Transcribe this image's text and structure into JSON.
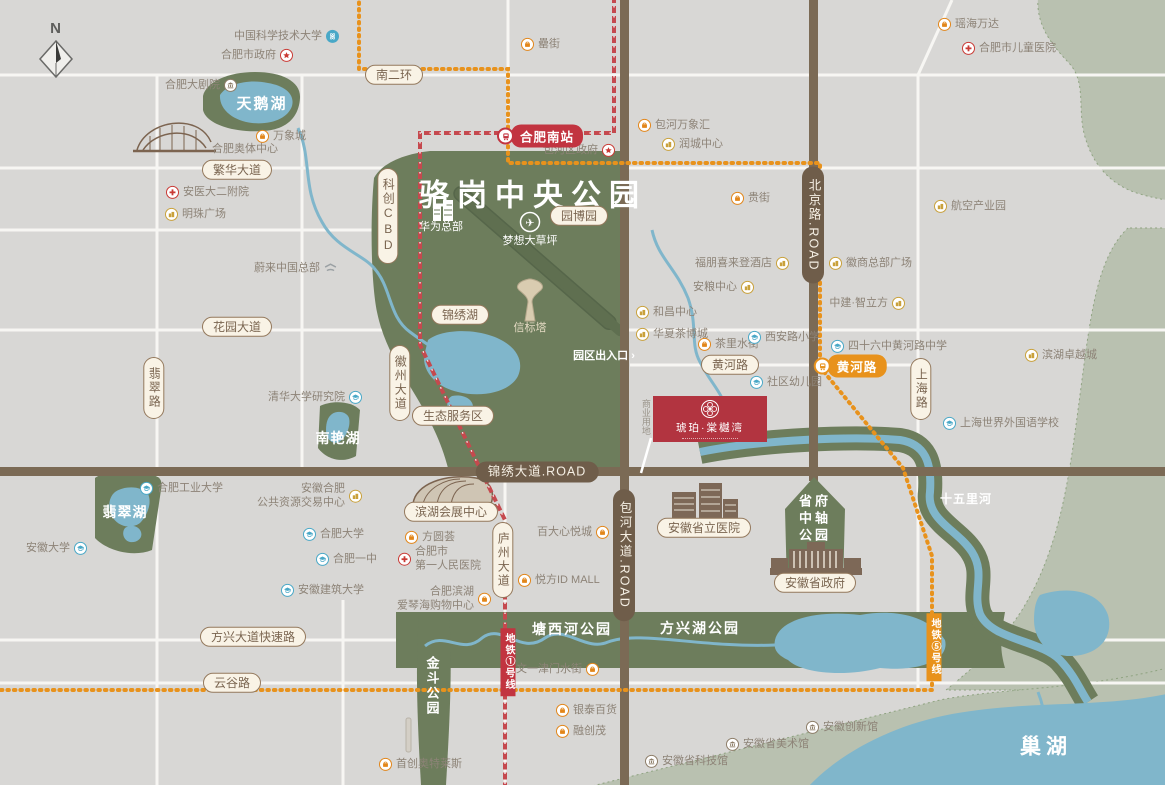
{
  "compass": {
    "label": "N"
  },
  "property": {
    "name": "琥珀·棠樾湾"
  },
  "park": {
    "title": "骆岗中央公园"
  },
  "colors": {
    "background": "#d8d7d5",
    "park_green": "#6d7d5c",
    "sage_green": "#b9c1b0",
    "water_blue": "#80b6cb",
    "road_brown": "#7b6a55",
    "metro_line1_red": "#c5494e",
    "metro_line5_orange": "#e8921c",
    "property_red": "#b23440",
    "poi_mall_orange": "#e2861a",
    "poi_biz_yellow": "#c9a13b",
    "poi_school_blue": "#49a8c7",
    "poi_gov_red": "#c93a35",
    "poi_museum_brown": "#8d7d68"
  },
  "metro": {
    "stations": [
      {
        "id": "hefei-south",
        "label": "合肥南站",
        "x": 540,
        "y": 136,
        "line": "red"
      },
      {
        "id": "huanghe-road",
        "label": "黄河路",
        "x": 850,
        "y": 366,
        "line": "orange"
      }
    ],
    "line_badges": [
      {
        "id": "line1",
        "label": "地铁①号线",
        "x": 508,
        "y": 662,
        "line": "red"
      },
      {
        "id": "line5",
        "label": "地铁⑤号线",
        "x": 934,
        "y": 647,
        "line": "orange"
      }
    ]
  },
  "road_labels": [
    {
      "id": "south-2nd-ring",
      "text": "南二环",
      "x": 394,
      "y": 75,
      "dir": "h",
      "style": "light"
    },
    {
      "id": "fanhua-ave",
      "text": "繁华大道",
      "x": 237,
      "y": 170,
      "dir": "h",
      "style": "light"
    },
    {
      "id": "huayuan-ave",
      "text": "花园大道",
      "x": 237,
      "y": 327,
      "dir": "h",
      "style": "light"
    },
    {
      "id": "feicui-road",
      "text": "翡翠路",
      "x": 154,
      "y": 388,
      "dir": "v",
      "style": "light"
    },
    {
      "id": "kechuang-cbd",
      "text": "科创CBD",
      "x": 388,
      "y": 216,
      "dir": "v",
      "style": "light"
    },
    {
      "id": "huizhou-ave",
      "text": "徽州大道",
      "x": 400,
      "y": 383,
      "dir": "v",
      "style": "light"
    },
    {
      "id": "jinxiu-lake",
      "text": "锦绣湖",
      "x": 460,
      "y": 315,
      "dir": "h",
      "style": "light"
    },
    {
      "id": "eco-service-area",
      "text": "生态服务区",
      "x": 453,
      "y": 416,
      "dir": "h",
      "style": "light"
    },
    {
      "id": "yuanboyuan",
      "text": "园博园",
      "x": 579,
      "y": 216,
      "dir": "h",
      "style": "light"
    },
    {
      "id": "huanghe-road-pill",
      "text": "黄河路",
      "x": 730,
      "y": 365,
      "dir": "h",
      "style": "light"
    },
    {
      "id": "shanghai-road",
      "text": "上海路",
      "x": 921,
      "y": 389,
      "dir": "v",
      "style": "light"
    },
    {
      "id": "luzhou-ave",
      "text": "庐州大道",
      "x": 503,
      "y": 560,
      "dir": "v",
      "style": "light"
    },
    {
      "id": "fangxing-expressway",
      "text": "方兴大道快速路",
      "x": 253,
      "y": 637,
      "dir": "h",
      "style": "light"
    },
    {
      "id": "yungu-road",
      "text": "云谷路",
      "x": 232,
      "y": 683,
      "dir": "h",
      "style": "light"
    },
    {
      "id": "binhu-expo-center",
      "text": "滨湖会展中心",
      "x": 451,
      "y": 512,
      "dir": "h",
      "style": "light"
    },
    {
      "id": "anhui-provincial-hospital",
      "text": "安徽省立医院",
      "x": 704,
      "y": 528,
      "dir": "h",
      "style": "light"
    },
    {
      "id": "anhui-provincial-gov",
      "text": "安徽省政府",
      "x": 815,
      "y": 583,
      "dir": "h",
      "style": "light"
    },
    {
      "id": "jinxiu-ave",
      "text": "锦绣大道.ROAD",
      "x": 537,
      "y": 472,
      "dir": "h",
      "style": "dark"
    },
    {
      "id": "baohe-ave",
      "text": "包河大道.ROAD",
      "x": 624,
      "y": 555,
      "dir": "v",
      "style": "dark"
    },
    {
      "id": "beijing-road",
      "text": "北京路.ROAD",
      "x": 813,
      "y": 225,
      "dir": "v",
      "style": "dark"
    }
  ],
  "area_labels": [
    {
      "id": "luogang-park-title",
      "text": "骆岗中央公园",
      "x": 533,
      "y": 196,
      "size": 30,
      "color": "#ffffff",
      "bold": true,
      "spacing": 8
    },
    {
      "id": "swan-lake",
      "text": "天鹅湖",
      "x": 262,
      "y": 104,
      "size": 15,
      "color": "#ffffff",
      "bold": true,
      "spacing": 2
    },
    {
      "id": "nanyan-lake",
      "text": "南艳湖",
      "x": 338,
      "y": 438,
      "size": 14,
      "color": "#ffffff",
      "bold": true,
      "spacing": 1
    },
    {
      "id": "feicui-lake",
      "text": "翡翠湖",
      "x": 125,
      "y": 512,
      "size": 14,
      "color": "#ffffff",
      "bold": true,
      "spacing": 1
    },
    {
      "id": "tangxihe-park",
      "text": "塘西河公园",
      "x": 572,
      "y": 629,
      "size": 14,
      "color": "#ffffff",
      "bold": true,
      "spacing": 2
    },
    {
      "id": "fangxinghu-park",
      "text": "方兴湖公园",
      "x": 700,
      "y": 628,
      "size": 14,
      "color": "#ffffff",
      "bold": true,
      "spacing": 2
    },
    {
      "id": "jindou-park",
      "text": "金斗公园",
      "x": 431,
      "y": 686,
      "size": 13,
      "color": "#ffffff",
      "bold": true,
      "vertical": true,
      "spacing": 2
    },
    {
      "id": "shiwuli-river",
      "text": "十五里河",
      "x": 966,
      "y": 500,
      "size": 12,
      "color": "#ffffff",
      "bold": true,
      "spacing": 1
    },
    {
      "id": "chao-lake",
      "text": "巢湖",
      "x": 1046,
      "y": 747,
      "size": 21,
      "color": "#ffffff",
      "bold": true,
      "spacing": 5
    },
    {
      "id": "park-entrance",
      "text": "园区出入口 ›",
      "x": 604,
      "y": 356,
      "size": 11,
      "color": "#ffffff",
      "bold": true
    },
    {
      "id": "dream-lawn",
      "text": "梦想大草坪",
      "x": 530,
      "y": 241,
      "size": 11,
      "color": "#ffffff"
    },
    {
      "id": "huawei-hq",
      "text": "华为总部",
      "x": 441,
      "y": 227,
      "size": 11,
      "color": "#ffffff"
    },
    {
      "id": "beacon-tower",
      "text": "信标塔",
      "x": 530,
      "y": 328,
      "size": 11,
      "color": "#e3d9c2"
    },
    {
      "id": "olympic-center",
      "text": "合肥奥体中心",
      "x": 245,
      "y": 149,
      "size": 11,
      "color": "#8d8377"
    },
    {
      "id": "commercial-plot",
      "text": "商业用地",
      "x": 645,
      "y": 417,
      "size": 9,
      "color": "#9a948a",
      "vertical": true
    },
    {
      "id": "shengfu-axis-park",
      "text": "省府\n中轴\n公园",
      "x": 815,
      "y": 519,
      "size": 13,
      "color": "#ffffff",
      "bold": true,
      "spacing": 3
    }
  ],
  "pois": [
    {
      "id": "ustc",
      "label": "中国科学技术大学",
      "x": 332,
      "y": 36,
      "type": "ustc",
      "side": "right"
    },
    {
      "id": "hefei-city-gov",
      "label": "合肥市政府",
      "x": 286,
      "y": 55,
      "type": "gov",
      "side": "right"
    },
    {
      "id": "hefei-grand-theater",
      "label": "合肥大剧院",
      "x": 230,
      "y": 85,
      "type": "theater",
      "side": "right"
    },
    {
      "id": "mixc",
      "label": "万象城",
      "x": 263,
      "y": 136,
      "type": "mall",
      "side": "left"
    },
    {
      "id": "anyi-2nd-hospital",
      "label": "安医大二附院",
      "x": 173,
      "y": 192,
      "type": "hospital",
      "side": "left"
    },
    {
      "id": "pearl-plaza",
      "label": "明珠广场",
      "x": 172,
      "y": 214,
      "type": "biz",
      "side": "left"
    },
    {
      "id": "lei-street",
      "label": "罍街",
      "x": 528,
      "y": 44,
      "type": "mall",
      "side": "left"
    },
    {
      "id": "baohe-district-gov",
      "label": "包河区政府",
      "x": 608,
      "y": 150,
      "type": "gov",
      "side": "right"
    },
    {
      "id": "baohe-mixc",
      "label": "包河万象汇",
      "x": 645,
      "y": 125,
      "type": "mall",
      "side": "left"
    },
    {
      "id": "runcheng-center",
      "label": "润城中心",
      "x": 669,
      "y": 144,
      "type": "biz",
      "side": "left"
    },
    {
      "id": "yaohai-wanda",
      "label": "瑶海万达",
      "x": 945,
      "y": 24,
      "type": "mall",
      "side": "left"
    },
    {
      "id": "children-hospital",
      "label": "合肥市儿童医院",
      "x": 969,
      "y": 48,
      "type": "hospital",
      "side": "left"
    },
    {
      "id": "aviation-industry-park",
      "label": "航空产业园",
      "x": 941,
      "y": 206,
      "type": "biz",
      "side": "left"
    },
    {
      "id": "gui-street",
      "label": "贵街",
      "x": 738,
      "y": 198,
      "type": "mall",
      "side": "left"
    },
    {
      "id": "sheraton-four-points",
      "label": "福朋喜来登酒店",
      "x": 782,
      "y": 263,
      "type": "biz",
      "side": "right"
    },
    {
      "id": "huishang-hq-plaza",
      "label": "徽商总部广场",
      "x": 836,
      "y": 263,
      "type": "biz",
      "side": "left"
    },
    {
      "id": "anliang-center",
      "label": "安粮中心",
      "x": 747,
      "y": 287,
      "type": "biz",
      "side": "right"
    },
    {
      "id": "zhongjian-zhilifang",
      "label": "中建·智立方",
      "x": 898,
      "y": 303,
      "type": "biz",
      "side": "right"
    },
    {
      "id": "hechang-center",
      "label": "和昌中心",
      "x": 643,
      "y": 312,
      "type": "biz",
      "side": "left"
    },
    {
      "id": "huaxia-tea-expo",
      "label": "华夏茶博城",
      "x": 643,
      "y": 334,
      "type": "biz",
      "side": "left"
    },
    {
      "id": "chali-water-street",
      "label": "茶里水街",
      "x": 705,
      "y": 344,
      "type": "mall",
      "side": "left"
    },
    {
      "id": "xian-road-primary",
      "label": "西安路小学",
      "x": 755,
      "y": 337,
      "type": "school",
      "side": "left"
    },
    {
      "id": "no46-huanghe-middle",
      "label": "四十六中黄河路中学",
      "x": 838,
      "y": 346,
      "type": "school",
      "side": "left"
    },
    {
      "id": "binhu-zhuoyue-town",
      "label": "滨湖卓越城",
      "x": 1032,
      "y": 355,
      "type": "biz",
      "side": "left"
    },
    {
      "id": "community-kindergarten",
      "label": "社区幼儿园",
      "x": 757,
      "y": 382,
      "type": "school",
      "side": "left"
    },
    {
      "id": "shanghai-world-foreign-school",
      "label": "上海世界外国语学校",
      "x": 950,
      "y": 423,
      "type": "school",
      "side": "left"
    },
    {
      "id": "nio-china-hq",
      "label": "蔚来中国总部",
      "x": 330,
      "y": 268,
      "type": "nio",
      "side": "right"
    },
    {
      "id": "tsinghua-research-institute",
      "label": "清华大学研究院",
      "x": 355,
      "y": 397,
      "type": "school",
      "side": "right"
    },
    {
      "id": "hefei-univ-tech",
      "label": "合肥工业大学",
      "x": 147,
      "y": 488,
      "type": "school",
      "side": "left"
    },
    {
      "id": "anhui-university",
      "label": "安徽大学",
      "x": 80,
      "y": 548,
      "type": "school",
      "side": "right"
    },
    {
      "id": "public-resource-center",
      "label": "安徽合肥\n公共资源交易中心",
      "x": 355,
      "y": 496,
      "type": "biz",
      "side": "right"
    },
    {
      "id": "hefei-university",
      "label": "合肥大学",
      "x": 310,
      "y": 534,
      "type": "school",
      "side": "left"
    },
    {
      "id": "hefei-no1-middle",
      "label": "合肥一中",
      "x": 323,
      "y": 559,
      "type": "school",
      "side": "left"
    },
    {
      "id": "anhui-jianzhu-univ",
      "label": "安徽建筑大学",
      "x": 288,
      "y": 590,
      "type": "school",
      "side": "left"
    },
    {
      "id": "fangyuanhui",
      "label": "方圆荟",
      "x": 412,
      "y": 537,
      "type": "mall",
      "side": "left"
    },
    {
      "id": "first-people-hospital",
      "label": "合肥市\n第一人民医院",
      "x": 405,
      "y": 559,
      "type": "hospital",
      "side": "left"
    },
    {
      "id": "aegean-mall",
      "label": "合肥滨湖\n爱琴海购物中心",
      "x": 484,
      "y": 599,
      "type": "mall",
      "side": "right"
    },
    {
      "id": "id-mall",
      "label": "悦方ID MALL",
      "x": 525,
      "y": 580,
      "type": "mall",
      "side": "left"
    },
    {
      "id": "baida-xinyue-city",
      "label": "百大心悦城",
      "x": 602,
      "y": 532,
      "type": "mall",
      "side": "right"
    },
    {
      "id": "wenyi-jinmen-water-street",
      "label": "文一津门水街",
      "x": 592,
      "y": 669,
      "type": "mall",
      "side": "right"
    },
    {
      "id": "yintai-dept-store",
      "label": "银泰百货",
      "x": 563,
      "y": 710,
      "type": "mall",
      "side": "left"
    },
    {
      "id": "sunac-mall",
      "label": "融创茂",
      "x": 563,
      "y": 731,
      "type": "mall",
      "side": "left"
    },
    {
      "id": "capital-outlets",
      "label": "首创奥特莱斯",
      "x": 386,
      "y": 764,
      "type": "mall",
      "side": "left"
    },
    {
      "id": "anhui-science-museum",
      "label": "安徽省科技馆",
      "x": 652,
      "y": 761,
      "type": "museum",
      "side": "left"
    },
    {
      "id": "anhui-art-museum",
      "label": "安徽省美术馆",
      "x": 733,
      "y": 744,
      "type": "museum",
      "side": "left"
    },
    {
      "id": "anhui-innovation-museum",
      "label": "安徽创新馆",
      "x": 813,
      "y": 727,
      "type": "museum",
      "side": "left"
    }
  ]
}
